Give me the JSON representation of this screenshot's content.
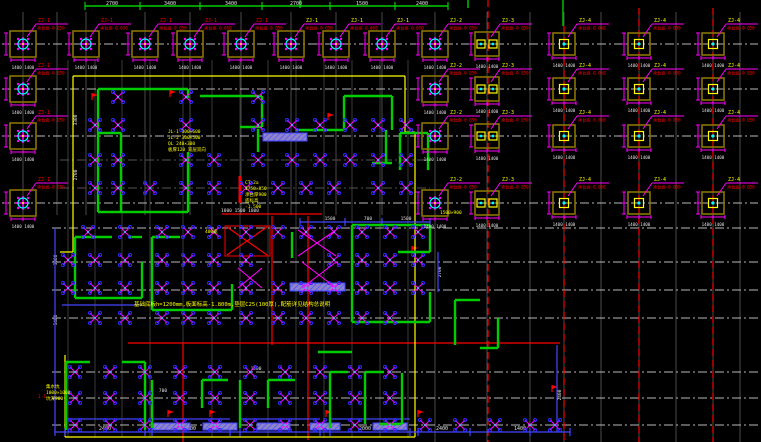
{
  "app": {
    "name": "cad-foundation-plan",
    "bg": "#000000"
  },
  "colors": {
    "cap_outline": "#8a7300",
    "cap_circle": "#00ffff",
    "magenta": "#ff00ff",
    "green": "#00cc00",
    "red": "#ff0000",
    "yellow": "#ffff00",
    "white": "#e0e0e0",
    "gray": "#4a4a4a",
    "dark": "#3a3a3a",
    "center": "#b8b8b8",
    "purple": "#4545ff",
    "lavender": "#8d84cc",
    "blue_dot": "#2b2bff"
  },
  "grid": {
    "gray_v_top": [
      23,
      57,
      86,
      145,
      190,
      241,
      291,
      336,
      382
    ],
    "gray_v_full": [
      435,
      487,
      530,
      564,
      601,
      639,
      676,
      713,
      740
    ],
    "dark_v_building": [
      68,
      95,
      122,
      150,
      183,
      212,
      240,
      268,
      296,
      324,
      352,
      380,
      408
    ],
    "h_centerlines": [
      44,
      89,
      136,
      203
    ],
    "h_centerlines_mid": [
      228,
      262,
      290,
      318
    ],
    "h_centerlines_low": [
      372,
      398,
      425
    ],
    "h_dark_building": [
      160,
      188
    ]
  },
  "red_lines": {
    "dashed_v": [
      [
        488,
        0,
        442
      ],
      [
        564,
        26,
        442
      ],
      [
        639,
        8,
        442
      ],
      [
        713,
        8,
        442
      ]
    ],
    "solid": [
      [
        272,
        216,
        272,
        345
      ],
      [
        308,
        216,
        308,
        440
      ],
      [
        183,
        343,
        183,
        442
      ],
      [
        222,
        214,
        322,
        214
      ],
      [
        128,
        343,
        560,
        343
      ],
      [
        240,
        176,
        240,
        203
      ],
      [
        227,
        227,
        267,
        255
      ],
      [
        267,
        227,
        227,
        255
      ]
    ],
    "shaft_rect": [
      225,
      226,
      45,
      30
    ],
    "flags": [
      [
        92,
        100
      ],
      [
        170,
        97
      ],
      [
        328,
        120
      ],
      [
        412,
        253
      ],
      [
        168,
        417
      ],
      [
        210,
        417
      ],
      [
        326,
        417
      ],
      [
        418,
        417
      ],
      [
        552,
        392
      ]
    ]
  },
  "yellow_boundary": [
    [
      73,
      76,
      405,
      76
    ],
    [
      73,
      76,
      73,
      252
    ],
    [
      60,
      252,
      73,
      252
    ],
    [
      405,
      76,
      405,
      132
    ],
    [
      405,
      132,
      415,
      132
    ],
    [
      415,
      132,
      415,
      437
    ],
    [
      65,
      437,
      415,
      437
    ],
    [
      65,
      355,
      65,
      437
    ]
  ],
  "top_dim": {
    "line_y": 6,
    "x1": 85,
    "x2": 448,
    "ticks": [
      85,
      140,
      200,
      262,
      330,
      395,
      448
    ],
    "stubs": [
      [
        300,
        0,
        300,
        8
      ],
      [
        468,
        0,
        468,
        8
      ],
      [
        563,
        0,
        563,
        26
      ]
    ],
    "texts": [
      {
        "x": 112,
        "t": "2700"
      },
      {
        "x": 170,
        "t": "3400"
      },
      {
        "x": 231,
        "t": "3400"
      },
      {
        "x": 296,
        "t": "2700"
      },
      {
        "x": 362,
        "t": "1500"
      },
      {
        "x": 422,
        "t": "2400"
      }
    ]
  },
  "bottom_dim": {
    "line_y": 432,
    "x1": 55,
    "x2": 570,
    "ticks": [
      55,
      65,
      145,
      152,
      230,
      240,
      320,
      330,
      410,
      418,
      470,
      530,
      570
    ],
    "texts": [
      {
        "x": 105,
        "t": "2400"
      },
      {
        "x": 190,
        "t": "2000"
      },
      {
        "x": 280,
        "t": "2400"
      },
      {
        "x": 365,
        "t": "2000"
      },
      {
        "x": 442,
        "t": "2400"
      },
      {
        "x": 520,
        "t": "1400"
      }
    ]
  },
  "pile_caps": [
    {
      "x": 23,
      "y": 44,
      "type": "A",
      "label": "ZJ-1",
      "lc": "red"
    },
    {
      "x": 86,
      "y": 44,
      "type": "A",
      "label": "ZJ-1",
      "lc": "red"
    },
    {
      "x": 145,
      "y": 44,
      "type": "A",
      "label": "ZJ-1",
      "lc": "red"
    },
    {
      "x": 190,
      "y": 44,
      "type": "A",
      "label": "ZJ-1",
      "lc": "red"
    },
    {
      "x": 241,
      "y": 44,
      "type": "A",
      "label": "ZJ-1",
      "lc": "red"
    },
    {
      "x": 291,
      "y": 44,
      "type": "A",
      "label": "ZJ-1",
      "lc": "yellow"
    },
    {
      "x": 336,
      "y": 44,
      "type": "A",
      "label": "ZJ-1",
      "lc": "yellow"
    },
    {
      "x": 382,
      "y": 44,
      "type": "A",
      "label": "ZJ-1",
      "lc": "yellow"
    },
    {
      "x": 435,
      "y": 44,
      "type": "A",
      "label": "ZJ-2",
      "lc": "yellow"
    },
    {
      "x": 487,
      "y": 44,
      "type": "B2",
      "label": "ZJ-3",
      "lc": "yellow"
    },
    {
      "x": 564,
      "y": 44,
      "type": "B1",
      "label": "ZJ-4",
      "lc": "yellow"
    },
    {
      "x": 639,
      "y": 44,
      "type": "B1",
      "label": "ZJ-4",
      "lc": "yellow"
    },
    {
      "x": 713,
      "y": 44,
      "type": "B1",
      "label": "ZJ-4",
      "lc": "yellow"
    },
    {
      "x": 23,
      "y": 89,
      "type": "A",
      "label": "ZJ-1",
      "lc": "red"
    },
    {
      "x": 435,
      "y": 89,
      "type": "A",
      "label": "ZJ-2",
      "lc": "yellow"
    },
    {
      "x": 487,
      "y": 89,
      "type": "B2",
      "label": "ZJ-3",
      "lc": "yellow"
    },
    {
      "x": 564,
      "y": 89,
      "type": "B1",
      "label": "ZJ-4",
      "lc": "yellow"
    },
    {
      "x": 639,
      "y": 89,
      "type": "B1",
      "label": "ZJ-4",
      "lc": "yellow"
    },
    {
      "x": 713,
      "y": 89,
      "type": "B1",
      "label": "ZJ-4",
      "lc": "yellow"
    },
    {
      "x": 23,
      "y": 136,
      "type": "A",
      "label": "ZJ-1",
      "lc": "red"
    },
    {
      "x": 435,
      "y": 136,
      "type": "A",
      "label": "ZJ-2",
      "lc": "yellow"
    },
    {
      "x": 487,
      "y": 136,
      "type": "B2",
      "label": "ZJ-3",
      "lc": "yellow"
    },
    {
      "x": 564,
      "y": 136,
      "type": "B1",
      "label": "ZJ-4",
      "lc": "yellow"
    },
    {
      "x": 639,
      "y": 136,
      "type": "B1",
      "label": "ZJ-4",
      "lc": "yellow"
    },
    {
      "x": 713,
      "y": 136,
      "type": "B1",
      "label": "ZJ-4",
      "lc": "yellow"
    },
    {
      "x": 23,
      "y": 203,
      "type": "A",
      "label": "ZJ-1",
      "lc": "red"
    },
    {
      "x": 435,
      "y": 203,
      "type": "A",
      "label": "ZJ-2",
      "lc": "yellow"
    },
    {
      "x": 487,
      "y": 203,
      "type": "B2",
      "label": "ZJ-3",
      "lc": "yellow"
    },
    {
      "x": 564,
      "y": 203,
      "type": "B1",
      "label": "ZJ-4",
      "lc": "yellow"
    },
    {
      "x": 639,
      "y": 203,
      "type": "B1",
      "label": "ZJ-4",
      "lc": "yellow"
    },
    {
      "x": 713,
      "y": 203,
      "type": "B1",
      "label": "ZJ-4",
      "lc": "yellow"
    }
  ],
  "cap_sub_label": "承台面-0.050",
  "cap_dim_text": "1400 1400",
  "walls": [
    [
      98,
      89,
      188,
      89
    ],
    [
      98,
      89,
      98,
      212
    ],
    [
      98,
      212,
      188,
      212
    ],
    [
      121,
      133,
      121,
      212
    ],
    [
      98,
      133,
      121,
      133
    ],
    [
      188,
      89,
      188,
      98
    ],
    [
      200,
      96,
      262,
      96
    ],
    [
      262,
      96,
      262,
      127
    ],
    [
      240,
      127,
      262,
      127
    ],
    [
      258,
      129,
      258,
      152
    ],
    [
      295,
      130,
      344,
      130
    ],
    [
      344,
      96,
      344,
      130
    ],
    [
      344,
      96,
      392,
      96
    ],
    [
      392,
      96,
      392,
      130
    ],
    [
      386,
      130,
      386,
      163
    ],
    [
      372,
      163,
      392,
      163
    ],
    [
      188,
      152,
      188,
      212
    ],
    [
      400,
      133,
      400,
      170
    ],
    [
      400,
      133,
      428,
      133
    ],
    [
      428,
      133,
      428,
      170
    ],
    [
      352,
      225,
      430,
      225
    ],
    [
      430,
      225,
      430,
      252
    ],
    [
      352,
      225,
      352,
      322
    ],
    [
      352,
      322,
      430,
      322
    ],
    [
      430,
      292,
      430,
      322
    ],
    [
      398,
      252,
      430,
      252
    ],
    [
      75,
      237,
      112,
      237
    ],
    [
      75,
      237,
      75,
      298
    ],
    [
      75,
      298,
      142,
      298
    ],
    [
      142,
      262,
      142,
      298
    ],
    [
      128,
      237,
      142,
      237
    ],
    [
      152,
      237,
      152,
      310
    ],
    [
      152,
      237,
      180,
      237
    ],
    [
      152,
      310,
      232,
      310
    ],
    [
      232,
      284,
      232,
      310
    ],
    [
      292,
      232,
      292,
      258
    ],
    [
      318,
      352,
      352,
      352
    ],
    [
      455,
      300,
      455,
      345
    ],
    [
      455,
      300,
      480,
      300
    ],
    [
      498,
      318,
      498,
      348
    ],
    [
      480,
      348,
      498,
      348
    ],
    [
      66,
      362,
      66,
      430
    ],
    [
      66,
      362,
      90,
      362
    ],
    [
      145,
      362,
      145,
      430
    ],
    [
      122,
      362,
      145,
      362
    ],
    [
      152,
      380,
      152,
      428
    ],
    [
      202,
      380,
      202,
      408
    ],
    [
      202,
      380,
      228,
      380
    ],
    [
      240,
      380,
      240,
      428
    ],
    [
      268,
      380,
      268,
      408
    ],
    [
      268,
      380,
      295,
      380
    ],
    [
      330,
      372,
      330,
      428
    ],
    [
      330,
      372,
      348,
      372
    ],
    [
      365,
      372,
      365,
      424
    ],
    [
      365,
      372,
      384,
      372
    ],
    [
      402,
      373,
      402,
      424
    ],
    [
      380,
      424,
      402,
      424
    ]
  ],
  "purple_lines": [
    [
      55,
      432,
      570,
      432
    ],
    [
      55,
      228,
      55,
      432
    ],
    [
      300,
      222,
      430,
      222
    ],
    [
      557,
      345,
      557,
      432
    ],
    [
      62,
      305,
      142,
      305
    ],
    [
      66,
      419,
      145,
      419
    ],
    [
      152,
      419,
      230,
      419
    ],
    [
      240,
      419,
      320,
      419
    ],
    [
      330,
      419,
      410,
      419
    ],
    [
      438,
      252,
      438,
      292
    ]
  ],
  "hatch_strips": [
    [
      263,
      133,
      44,
      8
    ],
    [
      290,
      283,
      55,
      8
    ],
    [
      153,
      423,
      37,
      7
    ],
    [
      203,
      423,
      34,
      7
    ],
    [
      257,
      423,
      33,
      7
    ],
    [
      310,
      423,
      30,
      7
    ],
    [
      373,
      423,
      34,
      7
    ]
  ],
  "pile_rows": [
    {
      "y": 97,
      "xs": [
        118,
        186,
        258
      ]
    },
    {
      "y": 125,
      "xs": [
        95,
        118,
        186,
        258,
        292,
        320,
        350,
        378,
        406
      ]
    },
    {
      "y": 160,
      "xs": [
        95,
        118,
        186,
        214,
        258,
        292,
        320,
        350,
        378,
        406
      ]
    },
    {
      "y": 188,
      "xs": [
        95,
        118,
        150,
        186,
        214,
        246,
        278,
        306,
        334,
        378,
        406
      ]
    },
    {
      "y": 232,
      "xs": [
        88,
        125,
        162,
        188,
        214,
        246,
        278,
        306,
        334,
        362,
        390,
        418
      ]
    },
    {
      "y": 260,
      "xs": [
        68,
        95,
        125,
        162,
        188,
        214,
        246,
        334,
        362,
        390,
        418
      ]
    },
    {
      "y": 288,
      "xs": [
        68,
        95,
        125,
        162,
        188,
        214,
        246,
        278,
        306,
        334,
        362,
        390,
        418
      ]
    },
    {
      "y": 318,
      "xs": [
        95,
        125,
        162,
        188,
        214,
        246,
        278,
        306,
        334,
        362,
        390
      ]
    },
    {
      "y": 372,
      "xs": [
        75,
        110,
        145,
        180,
        215,
        250,
        285,
        320,
        355,
        390
      ]
    },
    {
      "y": 398,
      "xs": [
        75,
        110,
        145,
        180,
        215,
        250,
        285,
        320,
        355,
        390
      ]
    },
    {
      "y": 425,
      "xs": [
        75,
        110,
        145,
        180,
        215,
        250,
        285,
        320,
        355,
        390,
        425,
        460,
        495,
        530,
        555
      ]
    }
  ],
  "shaft_braces": [
    [
      298,
      230,
      336,
      256
    ],
    [
      302,
      262,
      336,
      288
    ],
    [
      238,
      268,
      262,
      288
    ]
  ],
  "annotations": {
    "note_long": {
      "x": 134,
      "y": 306,
      "t": "基础底板h=1200mm,板面标高-1.800m,垫层C25(100厚),配筋详见结构总说明",
      "size": 5.5
    },
    "blocks": [
      {
        "x": 168,
        "y": 133,
        "lh": 6,
        "size": 4.5,
        "lines": [
          "JL-1 300×600",
          "JL-2 300×500",
          "QL  240×300",
          "板厚120 双层双向"
        ]
      },
      {
        "x": 245,
        "y": 184,
        "lh": 6,
        "size": 4.5,
        "lines": [
          "CT-2a",
          "1750×850",
          "承台厚900",
          "底标高",
          "-1.500"
        ]
      },
      {
        "x": 46,
        "y": 388,
        "lh": 6,
        "size": 4.5,
        "lines": [
          "集水坑",
          "1000×1000",
          "坑深900"
        ]
      }
    ],
    "tags": [
      {
        "x": 205,
        "y": 233,
        "t": "400宽"
      },
      {
        "x": 440,
        "y": 214,
        "t": "1500×900"
      }
    ],
    "red_small": {
      "x": 38,
      "y": 398,
      "t": "1-1"
    }
  },
  "white_texts": [
    {
      "x": 330,
      "y": 220,
      "t": "1500"
    },
    {
      "x": 368,
      "y": 220,
      "t": "700"
    },
    {
      "x": 406,
      "y": 220,
      "t": "1500"
    },
    {
      "x": 240,
      "y": 212,
      "t": "1800 1500 1800"
    },
    {
      "x": 163,
      "y": 392,
      "t": "700"
    },
    {
      "x": 256,
      "y": 370,
      "t": "1500"
    },
    {
      "x": 296,
      "y": 140,
      "t": "1500"
    }
  ],
  "rotated_texts": [
    {
      "x": 57,
      "y": 260,
      "t": "3300"
    },
    {
      "x": 57,
      "y": 320,
      "t": "5400"
    },
    {
      "x": 441,
      "y": 272,
      "t": "2700"
    },
    {
      "x": 561,
      "y": 395,
      "t": "2400"
    },
    {
      "x": 77,
      "y": 120,
      "t": "3300"
    },
    {
      "x": 77,
      "y": 175,
      "t": "2700"
    }
  ]
}
